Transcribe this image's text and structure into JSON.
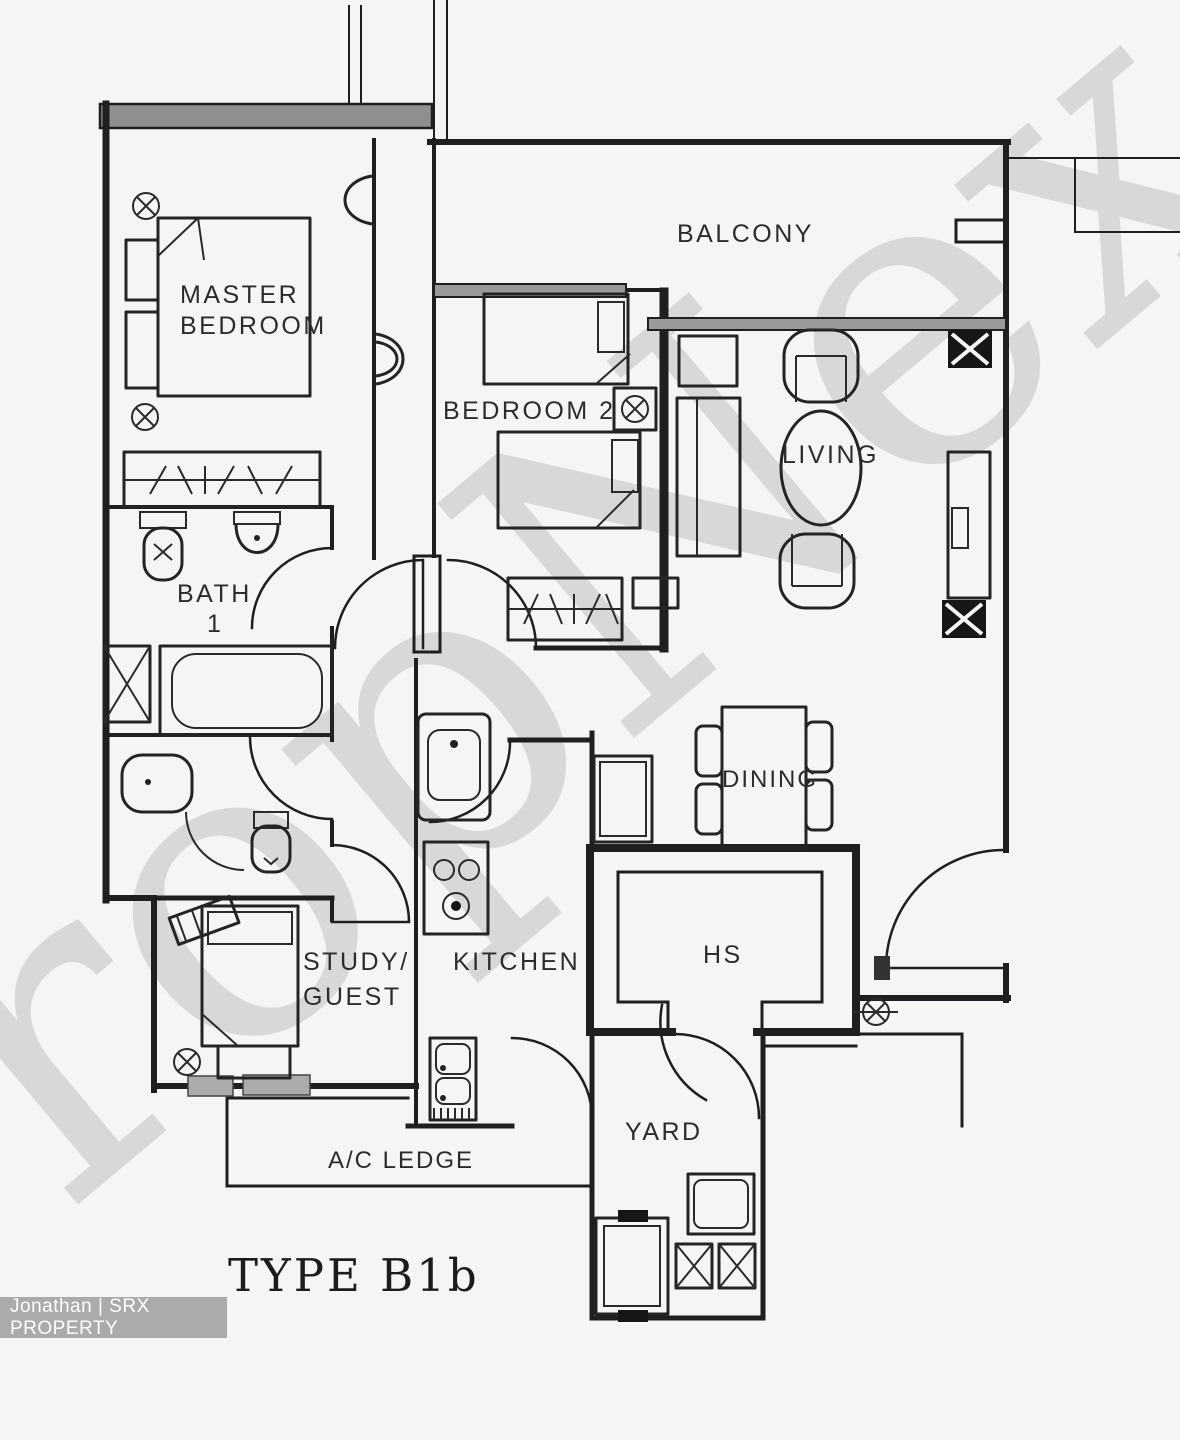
{
  "plan": {
    "title": "TYPE B1b",
    "watermark": "PropNex",
    "credit": "Jonathan | SRX PROPERTY"
  },
  "rooms": {
    "master_bedroom": {
      "line1": "MASTER",
      "line2": "BEDROOM"
    },
    "balcony": {
      "label": "BALCONY"
    },
    "bedroom2": {
      "label": "BEDROOM 2"
    },
    "living": {
      "label": "LIVING"
    },
    "bath1": {
      "line1": "BATH",
      "line2": "1"
    },
    "dining": {
      "label": "DINING"
    },
    "kitchen": {
      "label": "KITCHEN"
    },
    "hs": {
      "label": "HS"
    },
    "study": {
      "line1": "STUDY/",
      "line2": "GUEST"
    },
    "yard": {
      "label": "YARD"
    },
    "ac_ledge": {
      "label": "A/C LEDGE"
    }
  },
  "icons": {
    "light_point": "circle-cross-marker",
    "column": "filled-x-column",
    "shaft": "outlined-x-shaft"
  },
  "colors": {
    "line": "#1f1f1f",
    "watermark": "#d2d2d2",
    "badge_bg": "#ababab",
    "badge_text": "#ffffff",
    "paper": "#f5f5f3",
    "window_band": "#8f8f8f"
  }
}
